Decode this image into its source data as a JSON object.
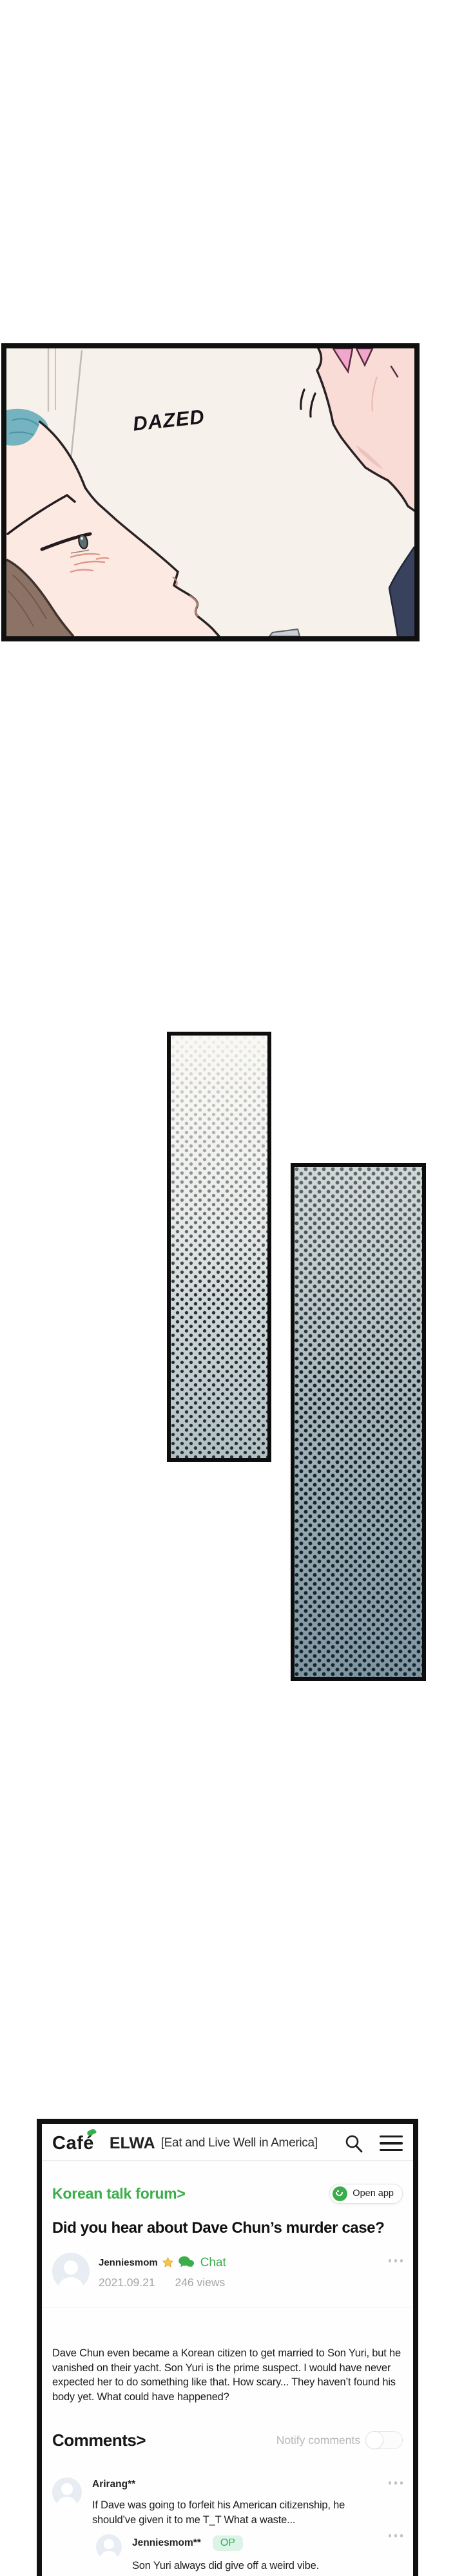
{
  "comic": {
    "sfx": "DAZED"
  },
  "app": {
    "logo": "Café",
    "community": "ELWA",
    "tagline": "[Eat and Live Well in America]",
    "colors": {
      "accent_green": "#3bae4b",
      "text_dark": "#1a1a1a",
      "text_gray": "#a5a5a5",
      "op_badge_bg": "#dcf4e7"
    },
    "icons": {
      "search": "search-icon",
      "menu": "hamburger-icon",
      "more": "more-dots-icon",
      "star": "star-icon",
      "chat": "chat-bubbles-icon",
      "open_app": "smiley-icon",
      "avatar": "person-icon",
      "toggle": "toggle-off"
    }
  },
  "forum": {
    "breadcrumb": "Korean talk forum>",
    "open_app_label": "Open app",
    "post": {
      "title": "Did you hear about Dave Chun’s murder case?",
      "author": "Jenniesmom",
      "chat_label": "Chat",
      "date": "2021.09.21",
      "views": "246 views",
      "body": "Dave Chun even became a Korean citizen to get married to Son Yuri, but he vanished on their yacht. Son Yuri is the prime suspect. I would have never expected her to do something like that. How scary... They haven’t found his body yet. What could have happened?"
    },
    "comments": {
      "heading": "Comments>",
      "notify_label": "Notify comments",
      "notify_on": false,
      "items": [
        {
          "author": "Arirang**",
          "text": "If Dave was going to forfeit his American citizenship, he should’ve given it to me T_T What a waste...",
          "badge": ""
        },
        {
          "author": "Jenniesmom**",
          "text": "Son Yuri always did give off a weird vibe.",
          "badge": "OP"
        }
      ]
    }
  }
}
